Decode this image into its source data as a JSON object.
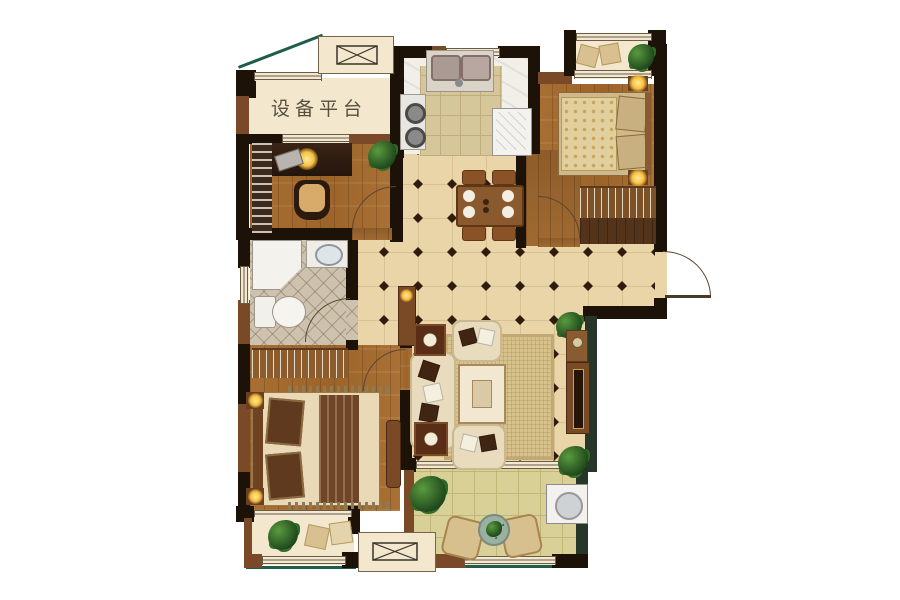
{
  "floorplan": {
    "labels": {
      "equipment_platform": "设备平台"
    },
    "colors": {
      "wall_dark": "#1d1208",
      "wall_brown": "#7a4a28",
      "wall_green": "#26372a",
      "edge_green": "#1f5c49",
      "tile_floor": "#e9d5a7",
      "tile_line": "#d2b98b",
      "tile_diamond": "#2f1c0e",
      "wood_floor": "#a2692f",
      "bathroom_tile": "#cdc2ad",
      "kitchen_floor": "#f2efe9",
      "balcony_tile": "#d9d098",
      "window_frame": "#f3e9d2",
      "platform_floor": "#f3e7cd",
      "lamp_glow": "#f5c13f",
      "rug": "#d8c28c",
      "sofa": "#e9dcbe"
    }
  }
}
